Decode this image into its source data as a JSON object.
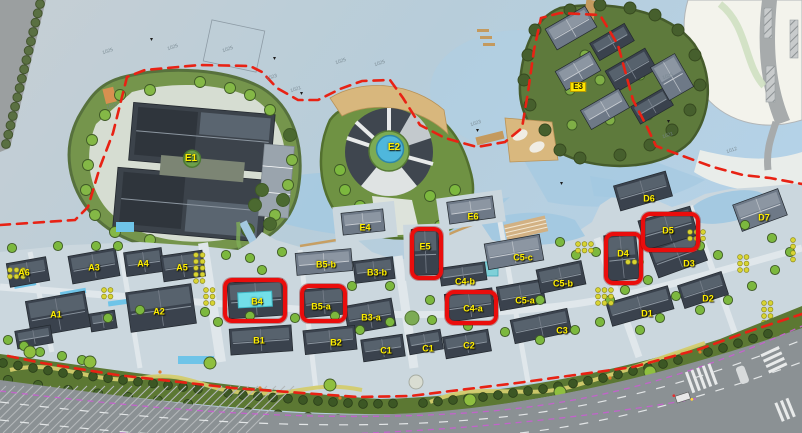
{
  "app": {
    "title": "Urban design master plan with highlighted plots"
  },
  "colors": {
    "highlight_red": "#ea0d0c",
    "boundary_red": "#e82214",
    "label_yellow": "#ffee00",
    "boxed_label_bg": "#ffe600",
    "cyan_building_highlight": "#72dfe8",
    "water": "#b7cdda",
    "paving": "#cbd7de",
    "greenbelt": "#5c7833",
    "road": "#8b9194"
  },
  "plan": {
    "labels": [
      {
        "id": "e1",
        "text": "E1",
        "x": 191,
        "y": 159,
        "style": "big"
      },
      {
        "id": "e2",
        "text": "E2",
        "x": 394,
        "y": 148,
        "style": "big"
      },
      {
        "id": "e3",
        "text": "E3",
        "x": 578,
        "y": 87,
        "style": "boxed"
      },
      {
        "id": "e4",
        "text": "E4",
        "x": 365,
        "y": 228,
        "style": ""
      },
      {
        "id": "e5",
        "text": "E5",
        "x": 425,
        "y": 247,
        "style": ""
      },
      {
        "id": "e6",
        "text": "E6",
        "x": 473,
        "y": 217,
        "style": ""
      },
      {
        "id": "a6",
        "text": "A6",
        "x": 24,
        "y": 273,
        "style": ""
      },
      {
        "id": "a3",
        "text": "A3",
        "x": 94,
        "y": 268,
        "style": ""
      },
      {
        "id": "a4",
        "text": "A4",
        "x": 143,
        "y": 264,
        "style": ""
      },
      {
        "id": "a5",
        "text": "A5",
        "x": 182,
        "y": 268,
        "style": ""
      },
      {
        "id": "a1",
        "text": "A1",
        "x": 56,
        "y": 315,
        "style": ""
      },
      {
        "id": "a2",
        "text": "A2",
        "x": 159,
        "y": 312,
        "style": ""
      },
      {
        "id": "b5b",
        "text": "B5-b",
        "x": 326,
        "y": 265,
        "style": ""
      },
      {
        "id": "b3b",
        "text": "B3-b",
        "x": 377,
        "y": 273,
        "style": ""
      },
      {
        "id": "b4",
        "text": "B4",
        "x": 257,
        "y": 302,
        "style": ""
      },
      {
        "id": "b5a",
        "text": "B5-a",
        "x": 321,
        "y": 307,
        "style": ""
      },
      {
        "id": "b3a",
        "text": "B3-a",
        "x": 371,
        "y": 318,
        "style": ""
      },
      {
        "id": "b1",
        "text": "B1",
        "x": 259,
        "y": 341,
        "style": ""
      },
      {
        "id": "b2",
        "text": "B2",
        "x": 336,
        "y": 343,
        "style": ""
      },
      {
        "id": "c1-west",
        "text": "C1",
        "x": 386,
        "y": 351,
        "style": ""
      },
      {
        "id": "c1-east",
        "text": "C1",
        "x": 428,
        "y": 349,
        "style": ""
      },
      {
        "id": "c2",
        "text": "C2",
        "x": 469,
        "y": 346,
        "style": ""
      },
      {
        "id": "c3",
        "text": "C3",
        "x": 562,
        "y": 331,
        "style": ""
      },
      {
        "id": "c4a",
        "text": "C4-a",
        "x": 473,
        "y": 309,
        "style": ""
      },
      {
        "id": "c4b",
        "text": "C4-b",
        "x": 465,
        "y": 282,
        "style": ""
      },
      {
        "id": "c5a",
        "text": "C5-a",
        "x": 525,
        "y": 301,
        "style": ""
      },
      {
        "id": "c5b",
        "text": "C5-b",
        "x": 563,
        "y": 284,
        "style": ""
      },
      {
        "id": "c5c",
        "text": "C5-c",
        "x": 523,
        "y": 258,
        "style": ""
      },
      {
        "id": "d1",
        "text": "D1",
        "x": 647,
        "y": 314,
        "style": ""
      },
      {
        "id": "d2",
        "text": "D2",
        "x": 708,
        "y": 299,
        "style": ""
      },
      {
        "id": "d3",
        "text": "D3",
        "x": 689,
        "y": 264,
        "style": ""
      },
      {
        "id": "d4",
        "text": "D4",
        "x": 623,
        "y": 254,
        "style": ""
      },
      {
        "id": "d5",
        "text": "D5",
        "x": 668,
        "y": 231,
        "style": ""
      },
      {
        "id": "d6",
        "text": "D6",
        "x": 649,
        "y": 199,
        "style": ""
      },
      {
        "id": "d7",
        "text": "D7",
        "x": 764,
        "y": 218,
        "style": ""
      }
    ],
    "highlight_boxes": [
      {
        "id": "b4",
        "label": "B4",
        "x": 223,
        "y": 278,
        "w": 64,
        "h": 45
      },
      {
        "id": "b5a",
        "label": "B5-a",
        "x": 300,
        "y": 284,
        "w": 47,
        "h": 39
      },
      {
        "id": "e5",
        "label": "E5",
        "x": 410,
        "y": 227,
        "w": 33,
        "h": 53
      },
      {
        "id": "c4a",
        "label": "C4-a",
        "x": 445,
        "y": 290,
        "w": 53,
        "h": 35
      },
      {
        "id": "d4",
        "label": "D4",
        "x": 604,
        "y": 232,
        "w": 39,
        "h": 53
      },
      {
        "id": "d5",
        "label": "D5",
        "x": 641,
        "y": 212,
        "w": 59,
        "h": 40
      }
    ],
    "water_annotations": [
      {
        "text": "1025",
        "x": 108,
        "y": 52
      },
      {
        "text": "1025",
        "x": 173,
        "y": 48
      },
      {
        "text": "1025",
        "x": 228,
        "y": 50
      },
      {
        "text": "1023",
        "x": 272,
        "y": 78
      },
      {
        "text": "1021",
        "x": 296,
        "y": 90
      },
      {
        "text": "1025",
        "x": 341,
        "y": 62
      },
      {
        "text": "1025",
        "x": 380,
        "y": 64
      },
      {
        "text": "1023",
        "x": 476,
        "y": 124
      },
      {
        "text": "1023",
        "x": 112,
        "y": 107
      },
      {
        "text": "1025",
        "x": 668,
        "y": 77
      },
      {
        "text": "1021",
        "x": 668,
        "y": 136
      },
      {
        "text": "1012",
        "x": 732,
        "y": 151
      }
    ]
  }
}
